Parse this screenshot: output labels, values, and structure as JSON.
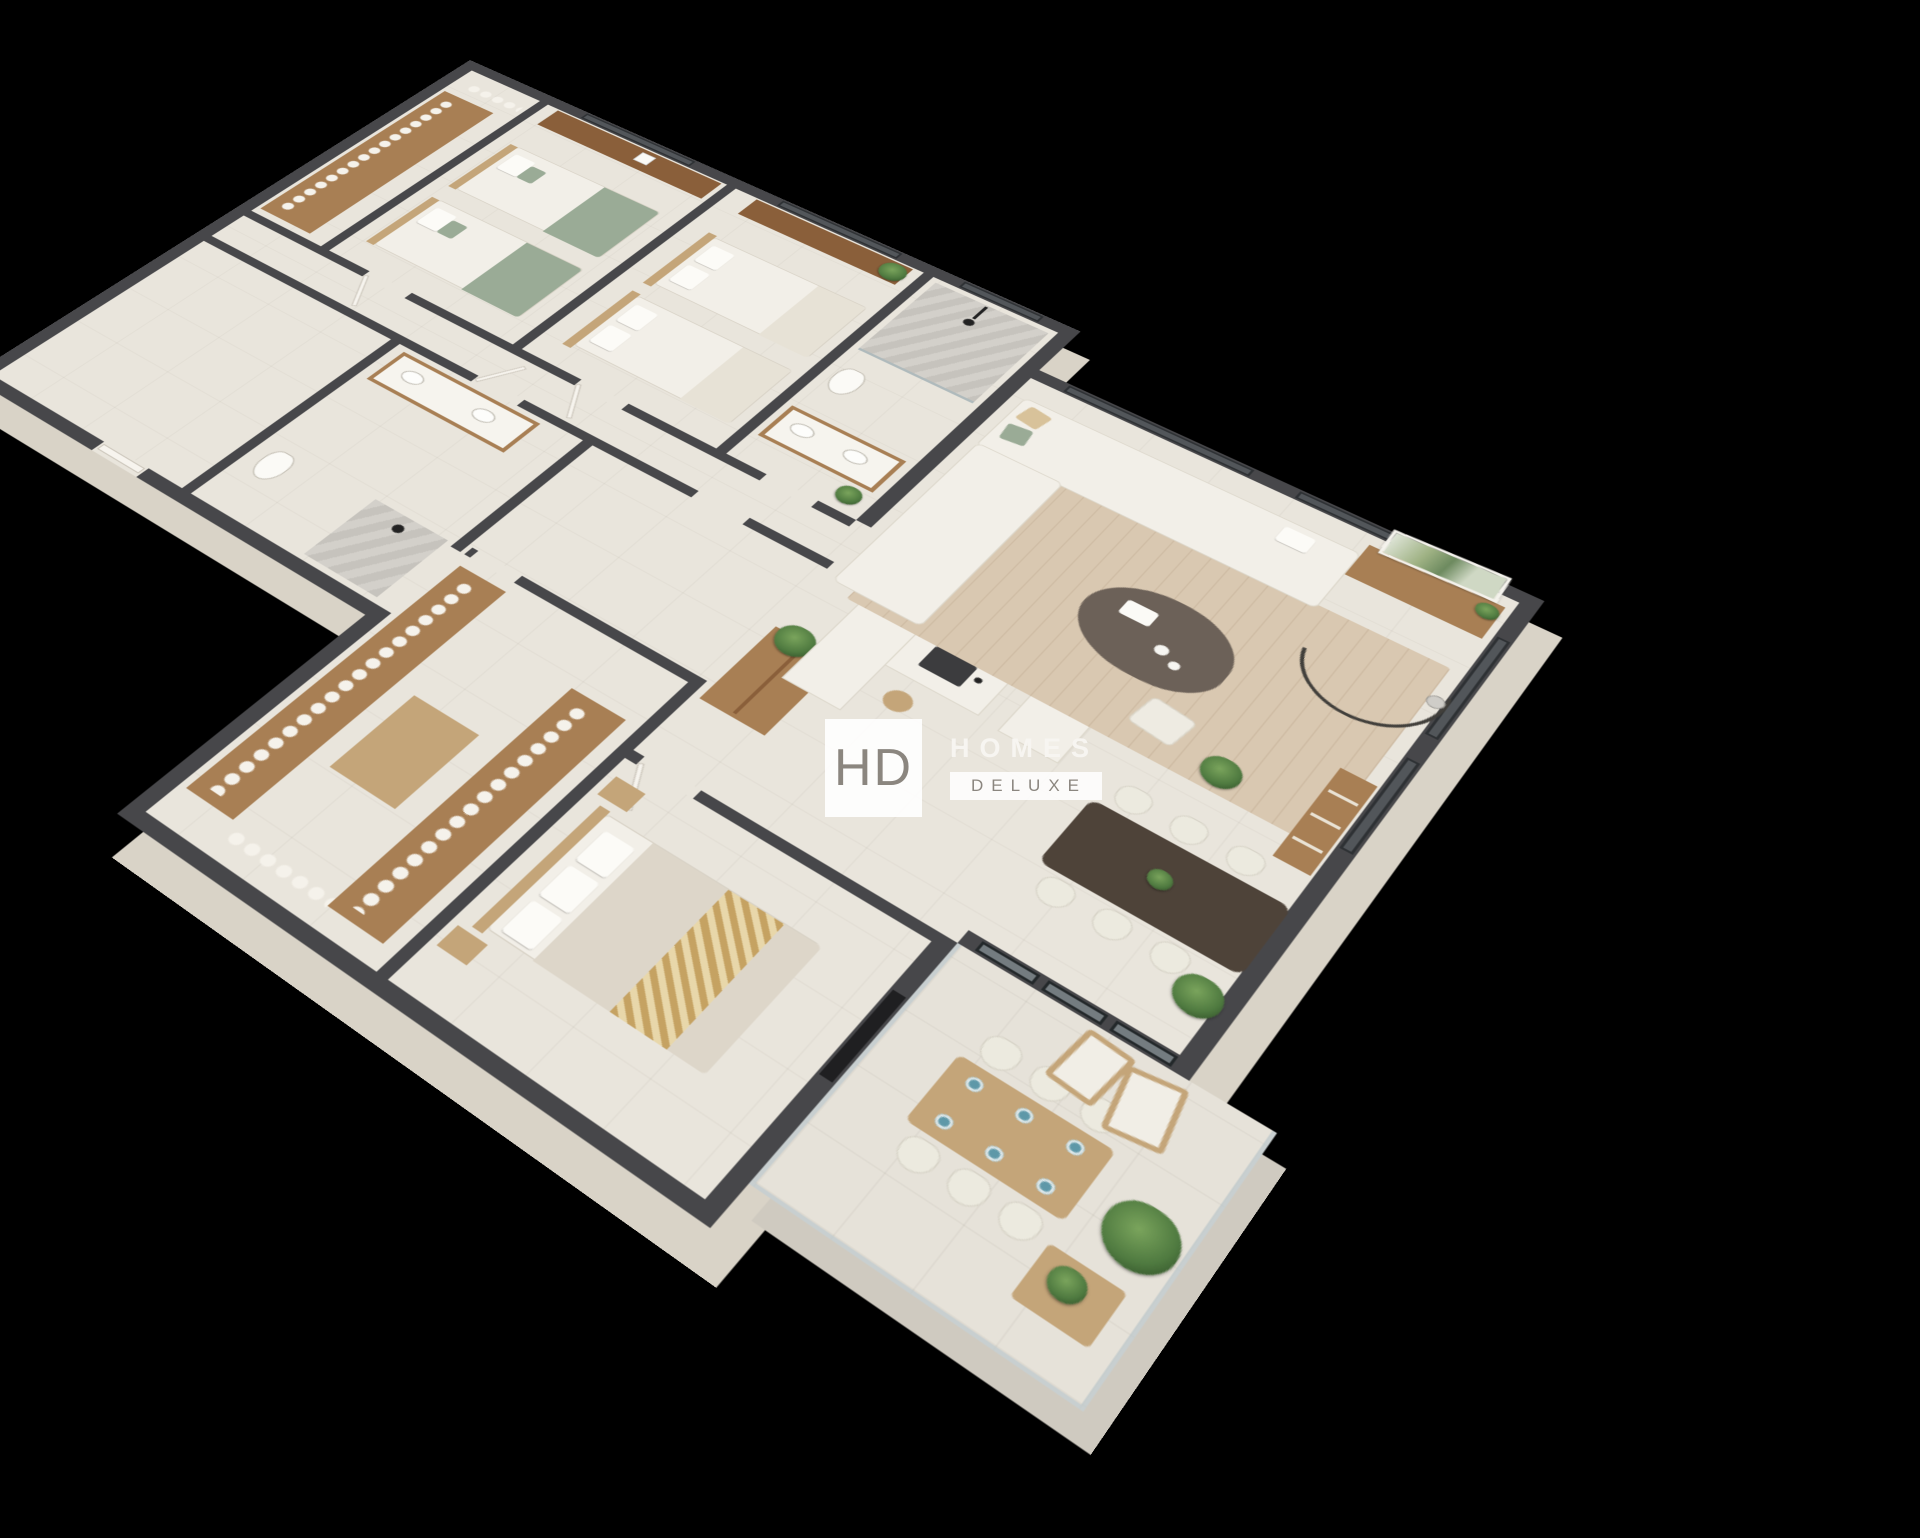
{
  "watermark": {
    "monogram": "HD",
    "title": "HOMES",
    "subtitle": "DELUXE"
  },
  "palette": {
    "bg": "#000000",
    "wall_top": "#47474a",
    "wall_face": "#d9d3c7",
    "floor": "#e9e5dc",
    "floor_terrace": "#e6e2d9",
    "wood": "#a87f54",
    "wood_light": "#c4a579",
    "wood_dark": "#8a5f3a",
    "fabric": "#f2efe8",
    "sage": "#9aab96",
    "rug": "#d9c8b1",
    "table_dark": "#4e4339",
    "coffee_table": "#6c6158",
    "plant": "#4f7a40",
    "gold": "#c5a262",
    "marble": "#cbc8c2",
    "glass": "#aeb9bd",
    "plate": "#5e98a8",
    "watermark_text": "#8b867f"
  }
}
